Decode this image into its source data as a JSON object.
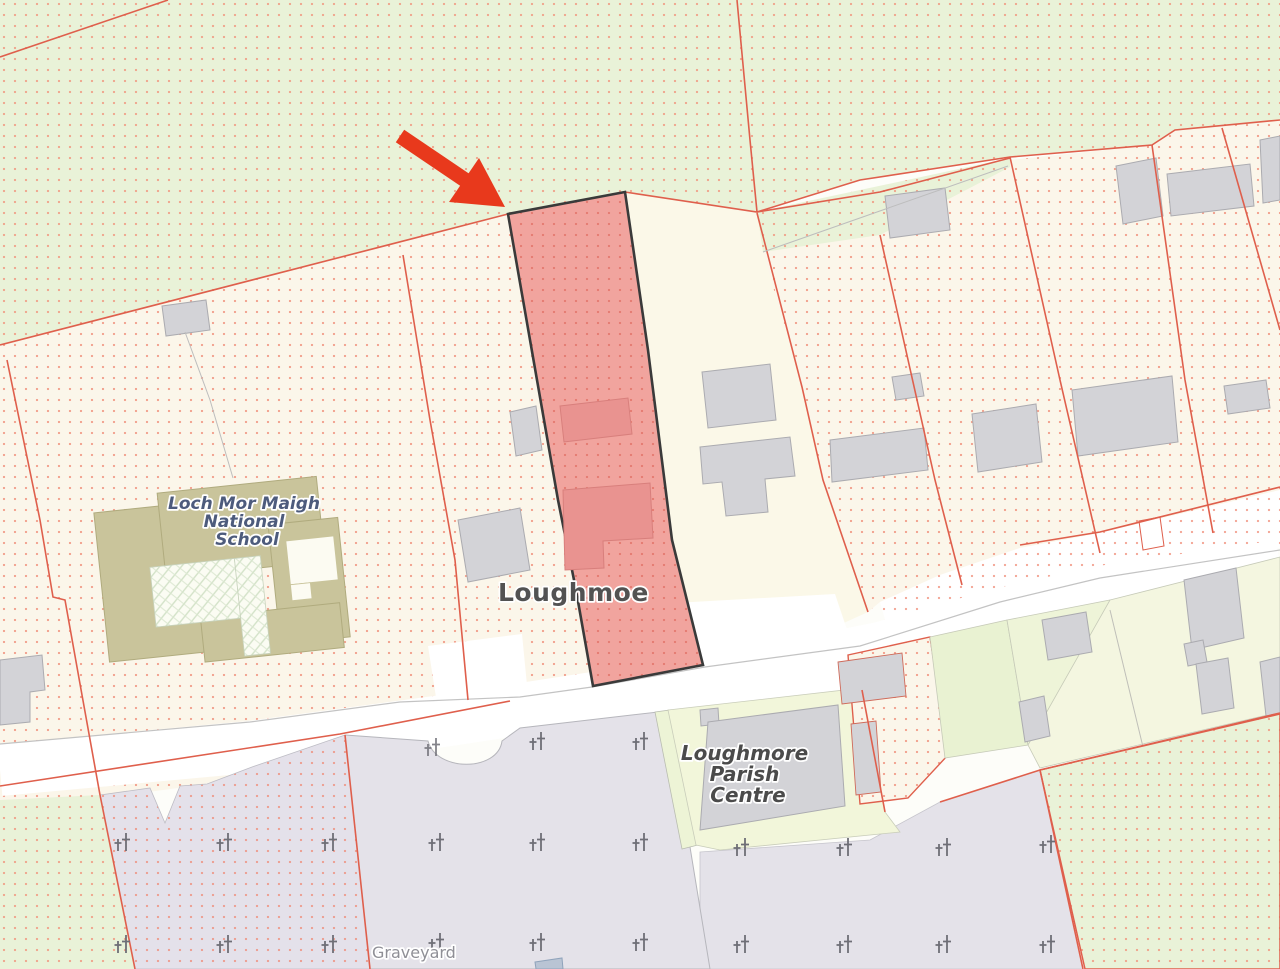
{
  "map": {
    "place_labels": {
      "school": {
        "line1": "Loch Mor Maigh",
        "line2": "National",
        "line3": "School"
      },
      "settlement": "Loughmoe",
      "parish_centre": {
        "line1": "Loughmore",
        "line2": "Parish",
        "line3": "Centre"
      },
      "graveyard": "Graveyard"
    },
    "annotations": {
      "highlight_arrow": {
        "color": "#e8391c",
        "points_to": "highlighted-parcel"
      }
    },
    "highlighted_parcel": {
      "fill": "#f1a49e",
      "outline": "#3a3a3a",
      "building_fill": "#e99390"
    },
    "palette": {
      "field_green": "#e9f2d8",
      "parcel_cream": "#fbf6ea",
      "parcel_plain_cream": "#fbf8e8",
      "dot_red": "#f0866f",
      "boundary_red": "#df5f4c",
      "building_gray": "#d3d3d7",
      "school_tan": "#c9c49b",
      "graveyard_lavender": "#e4e1ea",
      "graveyard_gray": "#e4e2e9",
      "parish_lot_green": "#f2f6da",
      "road_white": "#ffffff",
      "cross_gray": "#6e6e76",
      "label_slate": "#4d5b7c",
      "label_gray": "#525252",
      "label_light_gray": "#8f8f96"
    }
  }
}
